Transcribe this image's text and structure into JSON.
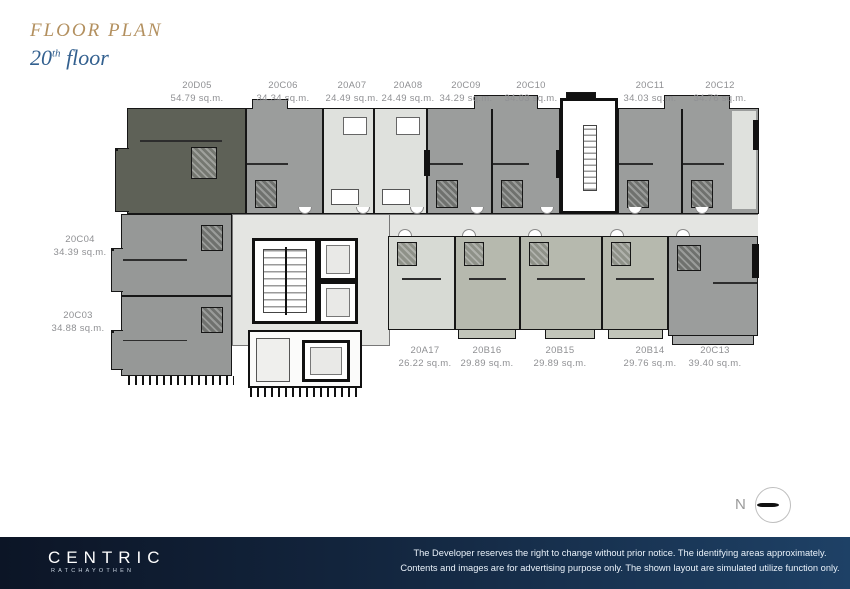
{
  "header": {
    "title": "FLOOR PLAN",
    "floor_number": "20",
    "floor_sup": "th",
    "floor_word": " floor"
  },
  "plan": {
    "top_units": [
      {
        "id": "20D05",
        "area": "54.79 sq.m."
      },
      {
        "id": "20C06",
        "area": "34.34 sq.m."
      },
      {
        "id": "20A07",
        "area": "24.49 sq.m."
      },
      {
        "id": "20A08",
        "area": "24.49 sq.m."
      },
      {
        "id": "20C09",
        "area": "34.29 sq.m."
      },
      {
        "id": "20C10",
        "area": "34.03 sq.m."
      },
      {
        "id": "20C11",
        "area": "34.03 sq.m."
      },
      {
        "id": "20C12",
        "area": "34.76 sq.m."
      }
    ],
    "left_units": [
      {
        "id": "20C04",
        "area": "34.39 sq.m."
      },
      {
        "id": "20C03",
        "area": "34.88 sq.m."
      }
    ],
    "bottom_units": [
      {
        "id": "20A17",
        "area": "26.22 sq.m."
      },
      {
        "id": "20B16",
        "area": "29.89 sq.m."
      },
      {
        "id": "20B15",
        "area": "29.89 sq.m."
      },
      {
        "id": "20B14",
        "area": "29.76 sq.m."
      },
      {
        "id": "20C13",
        "area": "39.40 sq.m."
      }
    ]
  },
  "compass": {
    "label": "N"
  },
  "footer": {
    "brand": "CENTRIC",
    "brand_sub": "RATCHAYOTHEN",
    "disclaimer_line1": "The Developer reserves the right to change without prior notice. The identifying areas approximately.",
    "disclaimer_line2": "Contents and images are for advertising purpose only. The shown layout are simulated utilize function only."
  },
  "colors": {
    "accent_gold": "#b3905f",
    "accent_navy": "#33608f",
    "footer_navy": "#13263f",
    "unit_dark": "#5e6157",
    "unit_gray": "#9b9d9c",
    "unit_pale": "#dfe1dd",
    "unit_green": "#b6b9ae",
    "corridor": "#e4e5e2",
    "label_gray": "#8f9093"
  }
}
